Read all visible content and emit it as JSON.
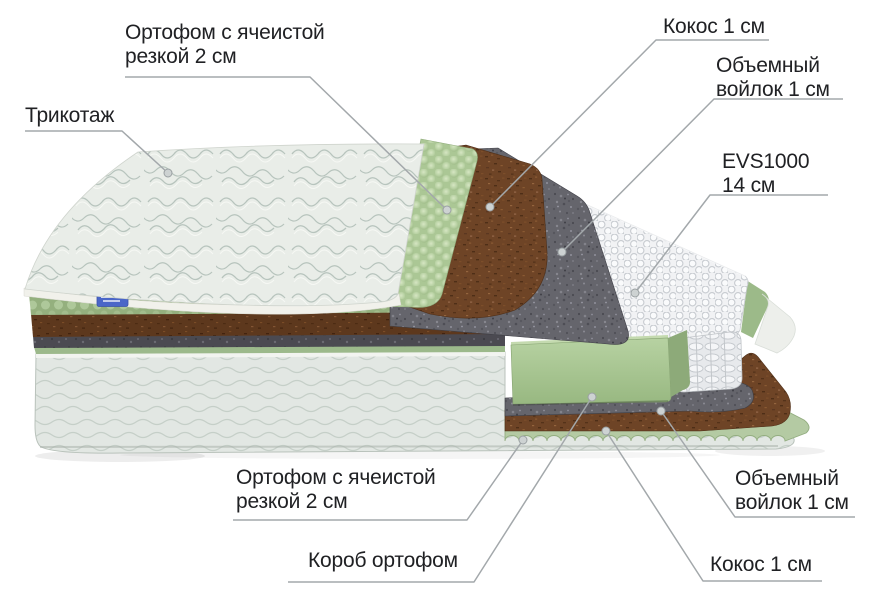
{
  "title": "Схема слоёв матраса",
  "labels": {
    "trikotazh": "Трикотаж",
    "ortofom_top": "Ортофом с ячеистой\nрезкой 2 см",
    "kokos_top": "Кокос 1 см",
    "voilok_top": "Объемный\nвойлок 1 см",
    "evs": "EVS1000\n14 см",
    "ortofom_bottom": "Ортофом с ячеистой\nрезкой 2 см",
    "korob": "Короб ортофом",
    "voilok_bottom": "Объемный\nвойлок 1 см",
    "kokos_bottom": "Кокос 1 см"
  },
  "colors": {
    "background": "#ffffff",
    "text": "#202124",
    "leader_line": "#a3a8ab",
    "foam_green": "#abc795",
    "coconut_brown": "#6e4426",
    "felt_gray": "#65656c",
    "spring_white": "#f1f2f4",
    "cover_white": "#e9ede8",
    "tag_blue": "#4a66c8"
  }
}
